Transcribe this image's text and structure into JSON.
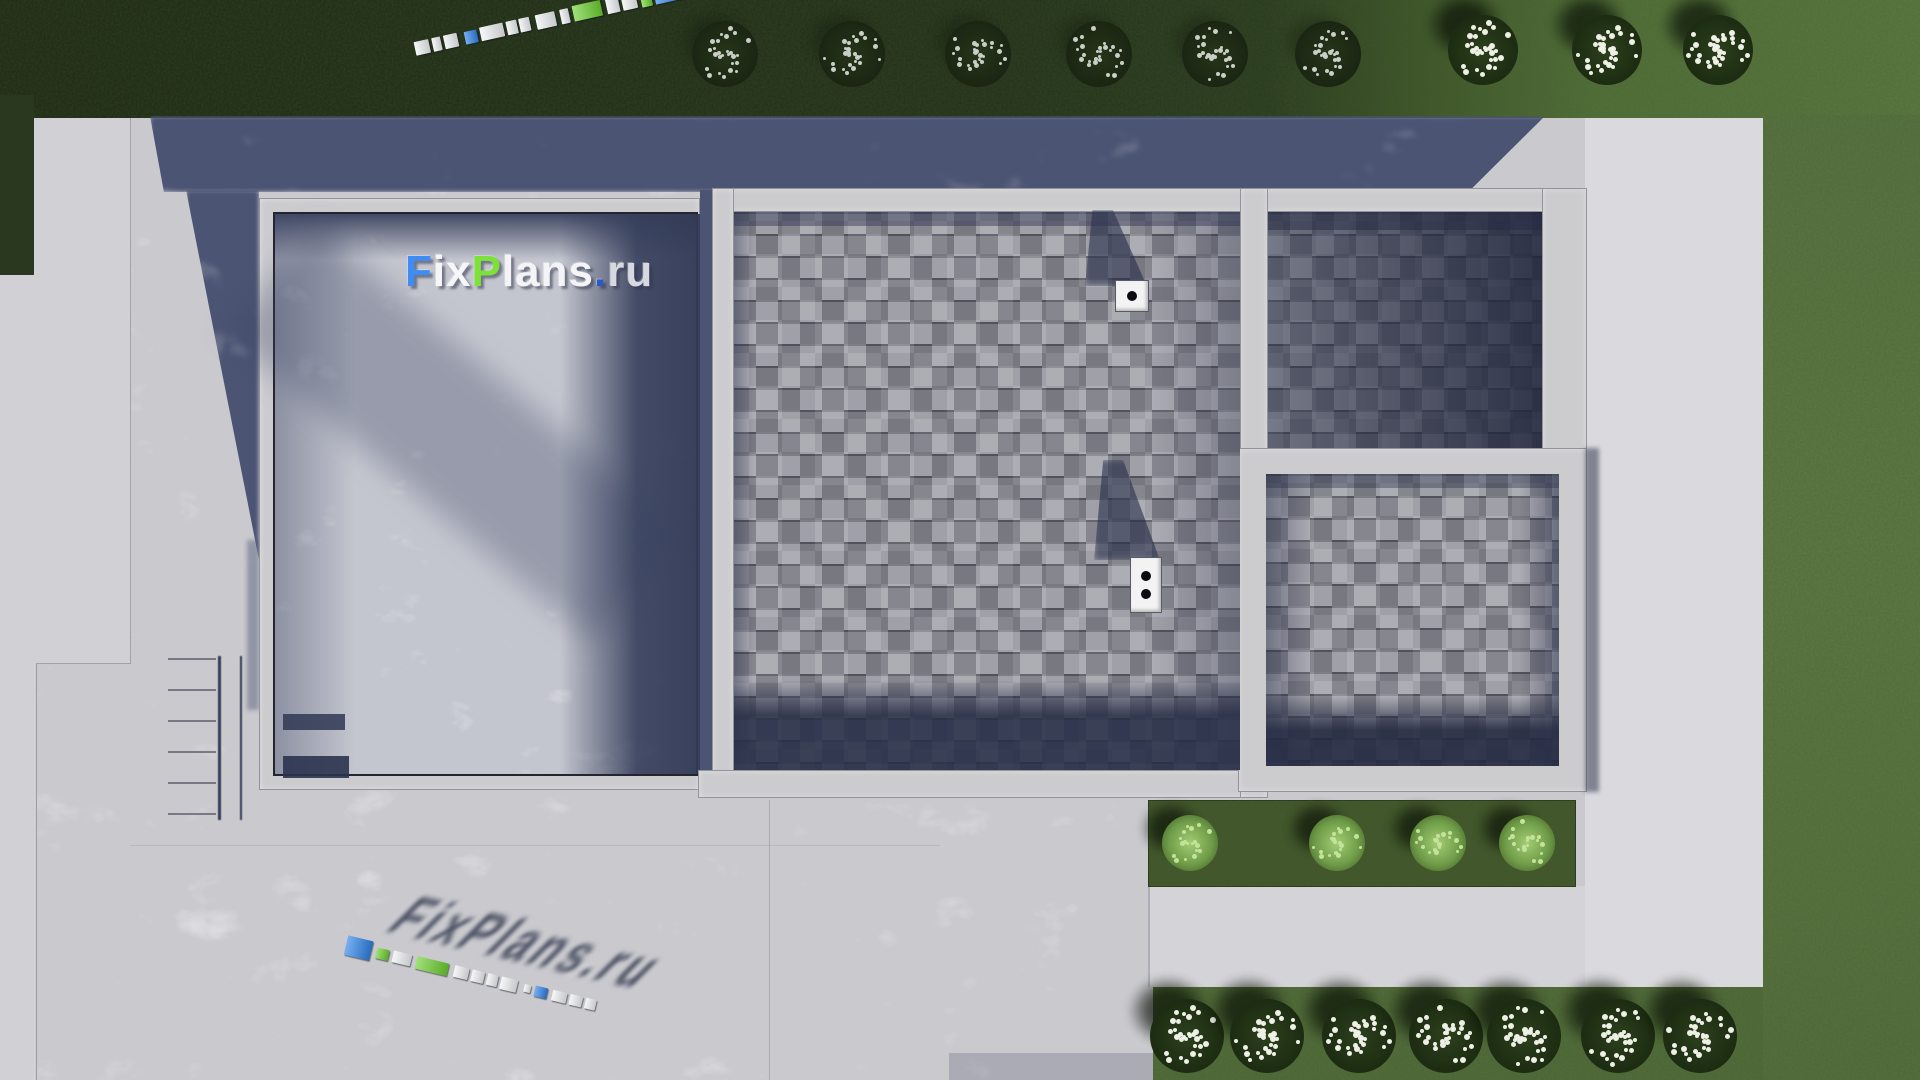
{
  "brand": {
    "name": "FixPlans.ru",
    "watermark_segments": [
      {
        "text": "F",
        "color": "#3f8df2"
      },
      {
        "text": "ix",
        "color": "#f6f6f8"
      },
      {
        "text": "P",
        "color": "#7ee03b"
      },
      {
        "text": "lans",
        "color": "#f4f4f6"
      },
      {
        "text": ".",
        "color": "#2b59cc"
      },
      {
        "text": "ru",
        "color": "#d6d9e0"
      }
    ]
  },
  "palette": {
    "logo_white": "#f2f3f5",
    "logo_blue": "#2f84e8",
    "logo_green": "#6ed132",
    "grass_shadow": "#232e1a",
    "grass_sunlit": "#5e7b44",
    "concrete_light": "#c9c9ce",
    "concrete_shadow": "#4b5473",
    "roof_gray": "#9a9aa2"
  },
  "logo_strips": {
    "top": {
      "x": 415,
      "y": 38,
      "angle": -12.5,
      "blocks": [
        {
          "w": 15,
          "h": 14,
          "c": "white"
        },
        {
          "g": 3,
          "w": 9,
          "h": 14,
          "c": "white"
        },
        {
          "g": 3,
          "w": 14,
          "h": 14,
          "c": "white"
        },
        {
          "g": 7,
          "w": 13,
          "h": 13,
          "c": "blue"
        },
        {
          "g": 3,
          "w": 24,
          "h": 14,
          "c": "white"
        },
        {
          "g": 3,
          "w": 11,
          "h": 14,
          "c": "white"
        },
        {
          "g": 2,
          "w": 11,
          "h": 14,
          "c": "white"
        },
        {
          "g": 6,
          "w": 20,
          "h": 15,
          "c": "white"
        },
        {
          "g": 5,
          "w": 9,
          "h": 15,
          "c": "white"
        },
        {
          "g": 4,
          "w": 29,
          "h": 16,
          "c": "green"
        },
        {
          "g": 5,
          "w": 13,
          "h": 16,
          "c": "white"
        },
        {
          "g": 3,
          "w": 15,
          "h": 16,
          "c": "white"
        },
        {
          "g": 4,
          "w": 11,
          "h": 17,
          "c": "green"
        },
        {
          "g": 3,
          "w": 28,
          "h": 18,
          "c": "blue"
        }
      ]
    },
    "bottom": {
      "x": 346,
      "y": 934,
      "angle": 13.5,
      "blocks": [
        {
          "w": 26,
          "h": 20,
          "c": "blue"
        },
        {
          "g": 5,
          "w": 13,
          "h": 11,
          "c": "green"
        },
        {
          "g": 4,
          "w": 19,
          "h": 12,
          "c": "white"
        },
        {
          "g": 5,
          "w": 33,
          "h": 13,
          "c": "green"
        },
        {
          "g": 6,
          "w": 15,
          "h": 12,
          "c": "white"
        },
        {
          "g": 3,
          "w": 13,
          "h": 12,
          "c": "white"
        },
        {
          "g": 3,
          "w": 11,
          "h": 12,
          "c": "white"
        },
        {
          "g": 3,
          "w": 17,
          "h": 13,
          "c": "white"
        },
        {
          "g": 7,
          "w": 7,
          "h": 8,
          "c": "white"
        },
        {
          "g": 4,
          "w": 13,
          "h": 11,
          "c": "blue"
        },
        {
          "g": 5,
          "w": 15,
          "h": 11,
          "c": "white"
        },
        {
          "g": 3,
          "w": 13,
          "h": 11,
          "c": "white"
        },
        {
          "g": 3,
          "w": 11,
          "h": 11,
          "c": "white"
        }
      ]
    }
  },
  "chimneys": [
    {
      "x": 1116,
      "y": 281,
      "w": 32,
      "h": 30,
      "dots": 1
    },
    {
      "x": 1131,
      "y": 558,
      "w": 30,
      "h": 54,
      "dots": 2
    }
  ],
  "planting": {
    "top_row_shaded": {
      "y": 54,
      "d": 66,
      "style": "flower-shade",
      "x": [
        725,
        852,
        978,
        1099,
        1215,
        1328
      ]
    },
    "top_row_sunlit": {
      "y": 50,
      "d": 70,
      "style": "flower-sun",
      "x": [
        1483,
        1607,
        1718
      ]
    },
    "bottom_row": {
      "y": 1036,
      "d": 74,
      "style": "flower-sun",
      "x": [
        1187,
        1267,
        1359,
        1446,
        1524,
        1618,
        1700
      ]
    },
    "bed_row": {
      "y": 843,
      "d": 56,
      "style": "leaf",
      "x": [
        1190,
        1337,
        1438,
        1527
      ]
    }
  }
}
